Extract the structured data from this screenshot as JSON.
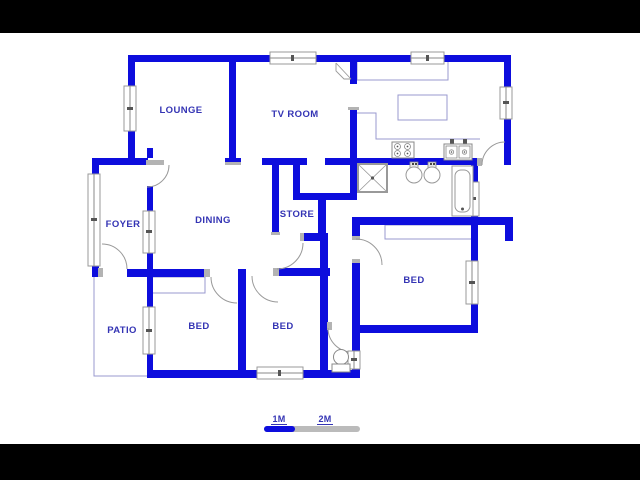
{
  "plan": {
    "rooms": {
      "lounge": {
        "label": "LOUNGE"
      },
      "tv_room": {
        "label": "TV ROOM"
      },
      "foyer": {
        "label": "FOYER"
      },
      "dining": {
        "label": "DINING"
      },
      "store": {
        "label": "STORE"
      },
      "patio": {
        "label": "PATIO"
      },
      "bed_left": {
        "label": "BED"
      },
      "bed_middle": {
        "label": "BED"
      },
      "bed_right": {
        "label": "BED"
      }
    },
    "scale_bar": {
      "mark_1m": "1M",
      "mark_2m": "2M"
    },
    "icons": {
      "shower": "shower-tray-icon",
      "basin_left": "washbasin-icon",
      "basin_right": "washbasin-icon",
      "bathtub": "bathtub-icon",
      "toilet": "toilet-icon",
      "stove": "stove-4-burner-icon",
      "kitchen_sink": "double-sink-icon",
      "corner_cabinet": "corner-cabinet-icon"
    },
    "colors": {
      "wall": "#0d0ddd",
      "label_text": "#3434b4",
      "counter_outline": "#9999cf",
      "fixture_outline": "#999999",
      "jamb_grey": "#b3b3b3",
      "scale_blue": "#0d0ddd",
      "scale_grey": "#bbbbbb",
      "letterbox": "#000000",
      "background": "#ffffff"
    }
  }
}
